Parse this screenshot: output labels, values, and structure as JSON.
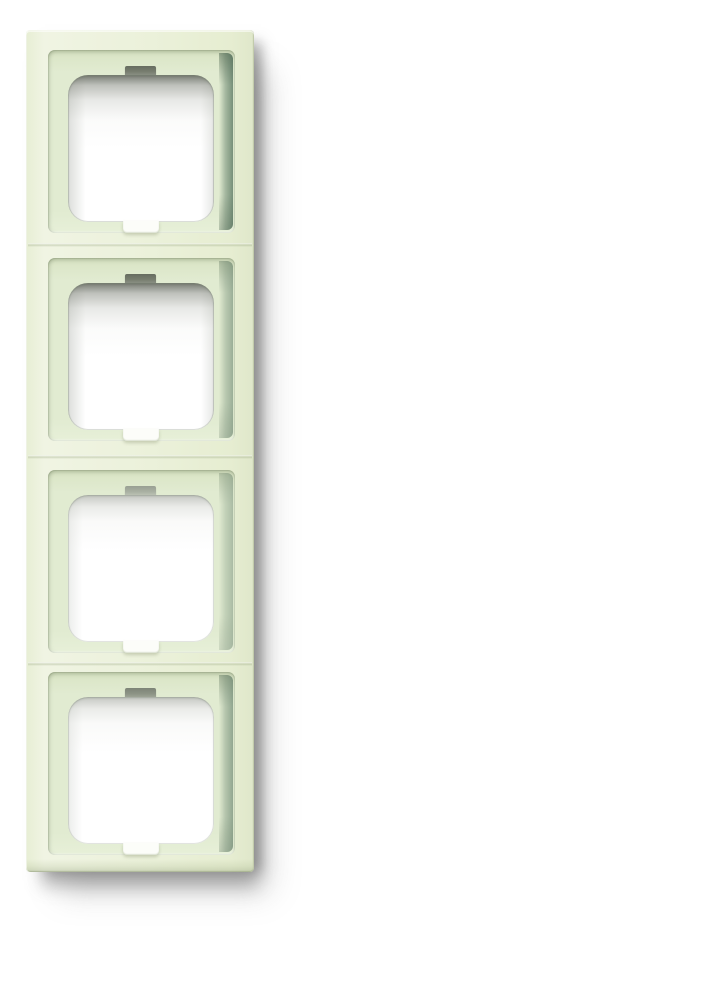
{
  "canvas": {
    "background_color": "#ffffff"
  },
  "product_photo": {
    "subject": "four-gang-switch-cover-frame",
    "orientation": "vertical",
    "gang_count": 4,
    "colors": {
      "background": "#ffffff",
      "frame_surface": "#ebf1da",
      "frame_surface_bright": "#f0f4e3",
      "frame_edge": "#dbe3c4",
      "recess_floor": "#e1ebd1",
      "recess_wall_shadow": "#718b75",
      "opening_top_shade": "#6c7167",
      "opening_fill": "#ffffff",
      "top_notch": "#777d6f",
      "bottom_notch": "#fcfdf9",
      "drop_shadow": "#a9a9a9"
    },
    "openings": [
      {
        "index": 1,
        "top_notch": true,
        "bottom_notch": true
      },
      {
        "index": 2,
        "top_notch": true,
        "bottom_notch": true
      },
      {
        "index": 3,
        "top_notch": true,
        "bottom_notch": true
      },
      {
        "index": 4,
        "top_notch": true,
        "bottom_notch": true
      }
    ]
  }
}
